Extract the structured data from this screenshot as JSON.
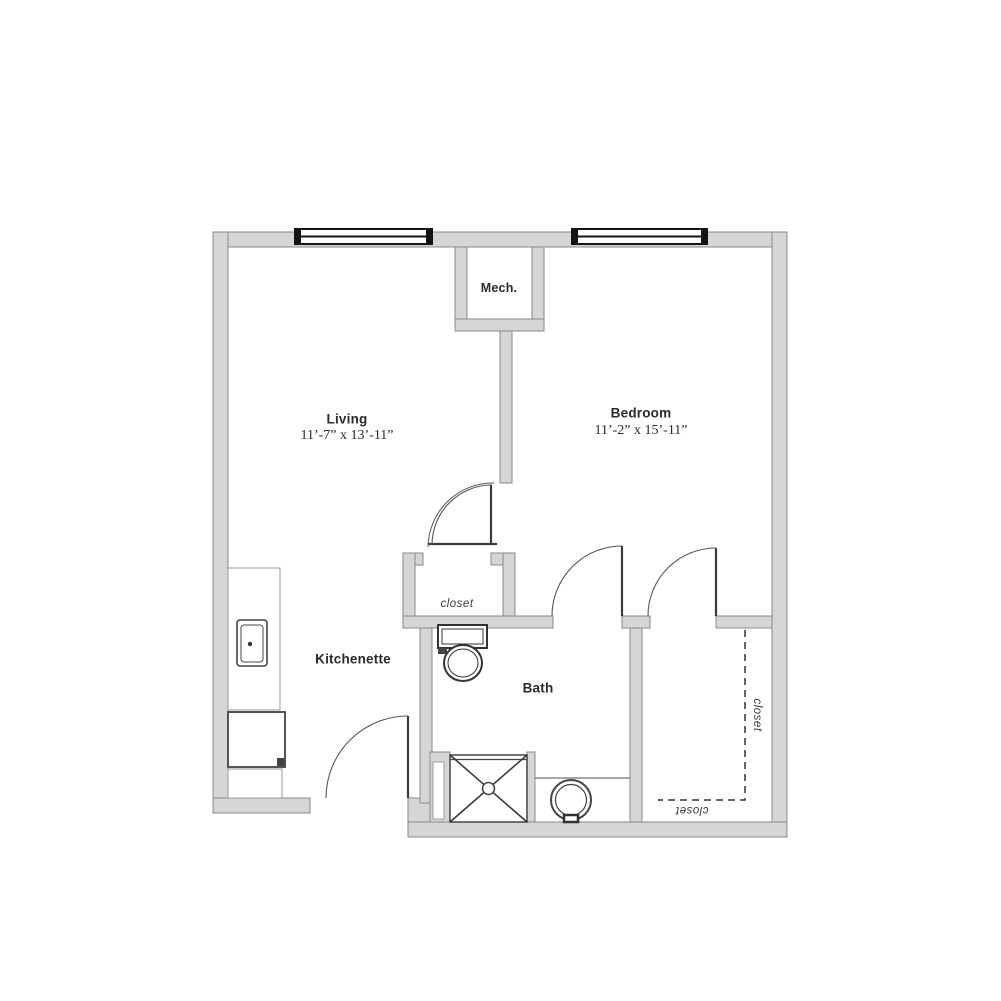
{
  "plan": {
    "title": "one-bedroom floor plan",
    "rooms": {
      "living": {
        "name": "Living",
        "dims": "11’-7” x 13’-11”"
      },
      "bedroom": {
        "name": "Bedroom",
        "dims": "11’-2” x 15’-11”"
      },
      "mech": {
        "name": "Mech."
      },
      "kitchenette": {
        "name": "Kitchenette"
      },
      "bath": {
        "name": "Bath"
      },
      "hall_closet": {
        "name": "closet"
      },
      "bedroom_closet_side": {
        "name": "closet"
      },
      "bedroom_closet_bottom": {
        "name": "closet"
      }
    },
    "colors": {
      "wall_fill": "#d6d6d4",
      "wall_outline": "#8a8a88",
      "dark_line": "#3c3c3c",
      "window_black": "#141414",
      "text": "#2a2a2a",
      "background": "#ffffff"
    }
  }
}
